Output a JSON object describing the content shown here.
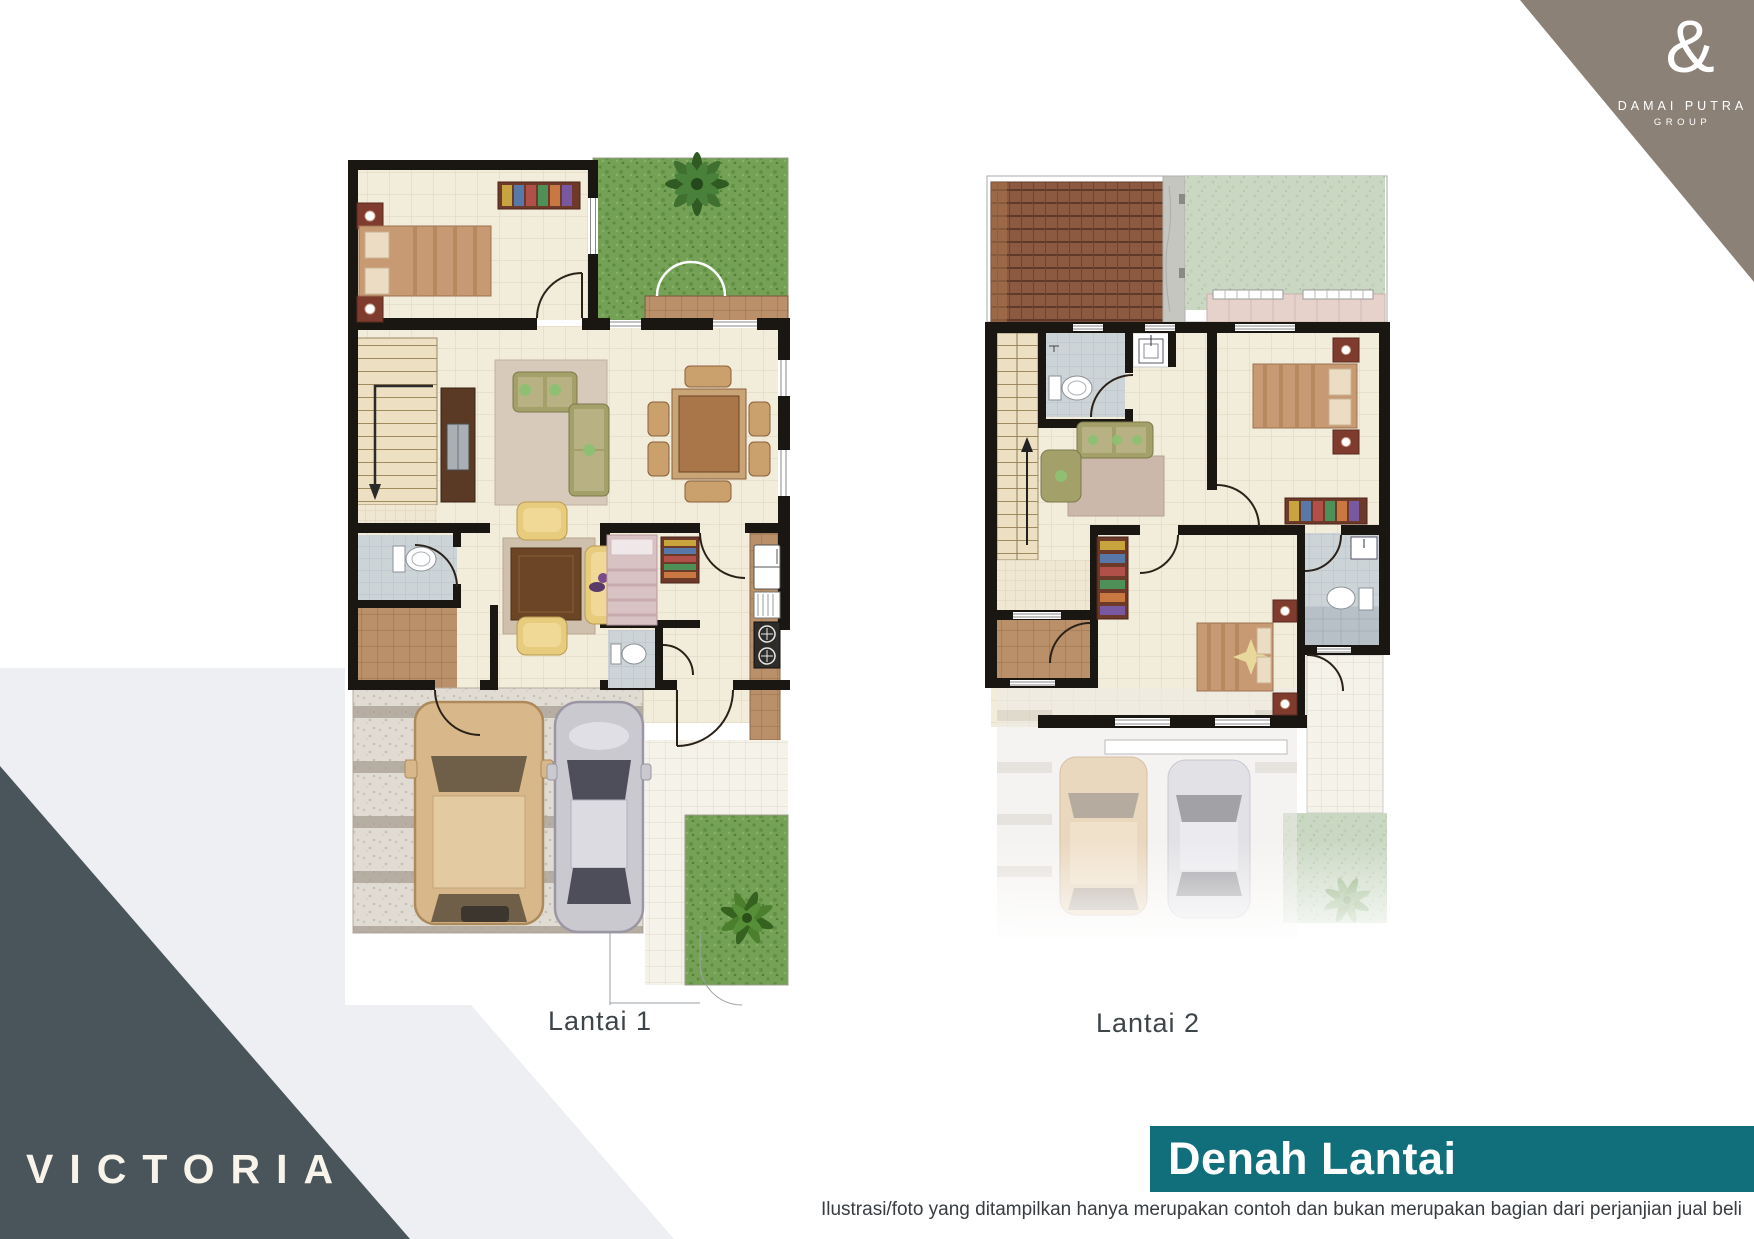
{
  "brand": {
    "ampersand": "&",
    "name_line1": "DAMAI PUTRA",
    "name_line2": "GROUP",
    "project": "VICTORIA"
  },
  "plans": [
    {
      "label": "Lantai 1",
      "features": [
        "bedroom",
        "garden-with-palm",
        "living-room",
        "dining-table",
        "stairs-down",
        "bathroom",
        "brown-tile-foyer",
        "family-sofa-set",
        "bedroom-2",
        "small-bathroom",
        "kitchen",
        "entrance-porch",
        "carport-with-two-cars",
        "back-garden-fern"
      ]
    },
    {
      "label": "Lantai 2",
      "features": [
        "roof-canopy",
        "side-garden",
        "balcony",
        "stairs-up",
        "bathroom",
        "wash-basin",
        "family-room-sofa",
        "bedroom",
        "wardrobe",
        "bedroom-2",
        "bathroom-2",
        "terrace",
        "ghost-carport-two-cars"
      ]
    }
  ],
  "footer": {
    "banner_title": "Denah Lantai",
    "disclaimer": "Ilustrasi/foto yang ditampilkan hanya merupakan contoh dan bukan merupakan bagian dari perjanjian jual beli"
  },
  "colors": {
    "teal": "#116e7b",
    "darkslate": "#4a555b",
    "taupe": "#8b8177",
    "lightwedge": "#edeff2",
    "labelcolor": "#3e4549",
    "wallcolor": "#1a1713",
    "floorbeige": "#f2ecdb",
    "bathgray": "#cdd4d8",
    "browntile": "#b9906a",
    "grassgreen": "#74a156",
    "palegrass": "#cad8c3",
    "rooftile": "#8c5a41",
    "concrete": "#e0dcd4",
    "sofaolive": "#a3a06a",
    "sofayellow": "#e8cc7e",
    "bedtan": "#c89a74",
    "bedpink": "#d8c2c4",
    "cartan": "#d8b88a",
    "carsilver": "#cbc9d0"
  }
}
